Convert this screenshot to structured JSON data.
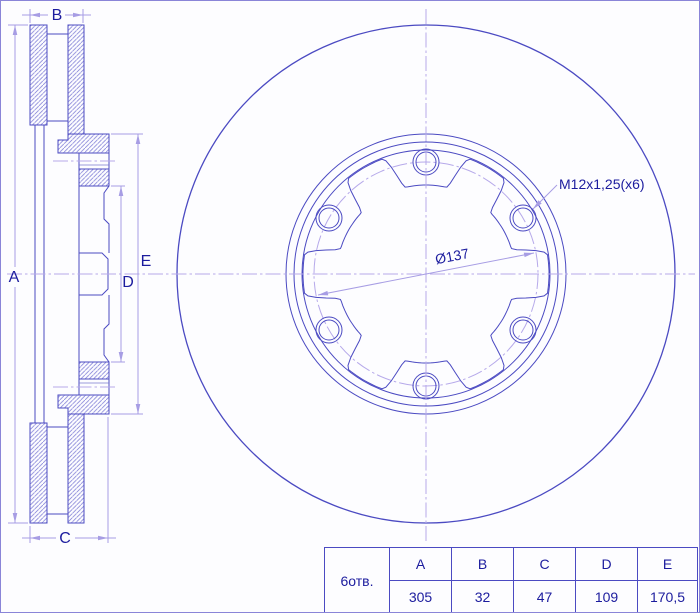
{
  "drawing": {
    "type": "brake-disc technical drawing",
    "annotations": {
      "thread": "M12x1,25(x6)",
      "bolt_circle_dia": "Ø137"
    },
    "dim_labels": {
      "a": "A",
      "b": "B",
      "c": "C",
      "d": "D",
      "e": "E"
    },
    "table": {
      "holes_label": "6отв.",
      "columns": [
        "A",
        "B",
        "C",
        "D",
        "E"
      ],
      "values": [
        "305",
        "32",
        "47",
        "109",
        "170,5"
      ]
    },
    "colors": {
      "line": "#4b4ac2",
      "dimension": "#a79de4",
      "centerline": "#b6a9ea",
      "text": "#1c1c9e",
      "hatch": "#8583d8",
      "background": "#fdfdff"
    }
  }
}
